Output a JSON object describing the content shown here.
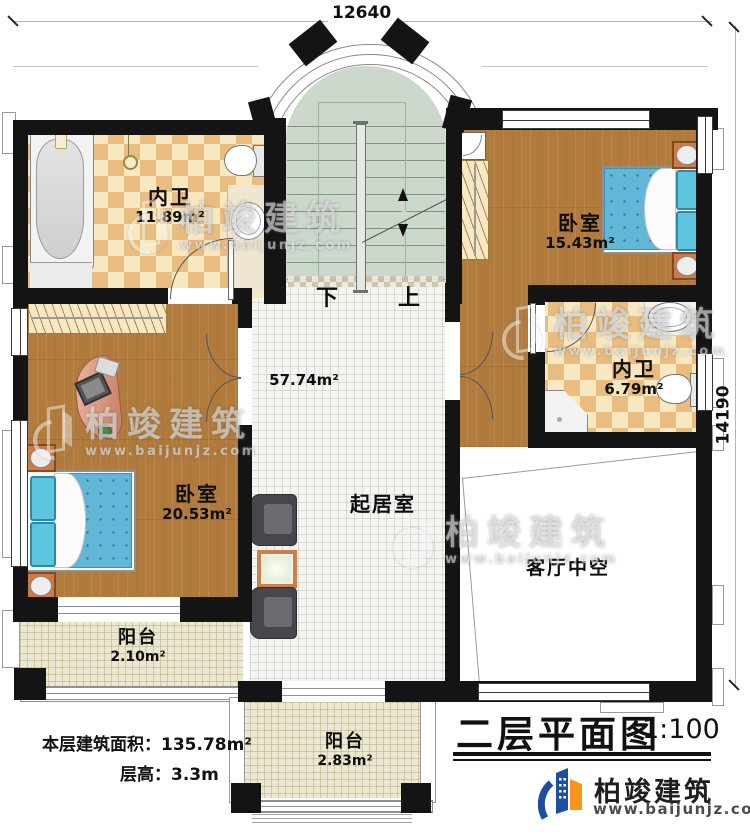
{
  "plan": {
    "dimensions": {
      "width_mm": "12640",
      "height_mm": "14190"
    },
    "stairs": {
      "down_label": "下",
      "up_label": "上"
    },
    "rooms": {
      "bath_top": {
        "name": "内卫",
        "area": "11.89m²"
      },
      "bedroom_right": {
        "name": "卧室",
        "area": "15.43m²"
      },
      "bath_right": {
        "name": "内卫",
        "area": "6.79m²"
      },
      "bedroom_left": {
        "name": "卧室",
        "area": "20.53m²"
      },
      "living": {
        "name": "起居室",
        "area": "57.74m²"
      },
      "void": {
        "name": "客厅中空"
      },
      "balcony_left": {
        "name": "阳台",
        "area": "2.10m²"
      },
      "balcony_bottom": {
        "name": "阳台",
        "area": "2.83m²"
      }
    },
    "info": {
      "floor_area_label": "本层建筑面积：",
      "floor_area_value": "135.78m²",
      "floor_height_label": "层高：",
      "floor_height_value": "3.3m"
    },
    "title": {
      "text": "二层平面图",
      "scale": "1:100"
    }
  },
  "brand": {
    "name": "柏竣建筑",
    "website": "www.baijunjz.com"
  },
  "watermark": {
    "name": "柏竣建筑",
    "website": "www.baijunjz.com"
  },
  "colors": {
    "wall": "#141414",
    "wood_floor": "#b07b3c",
    "tile_checker": "#e9bd80",
    "stair_floor": "#cdd8cc",
    "bed_blue": "#62b7d7",
    "logo_blue": "#1d4f9e",
    "logo_orange": "#f7941d"
  }
}
